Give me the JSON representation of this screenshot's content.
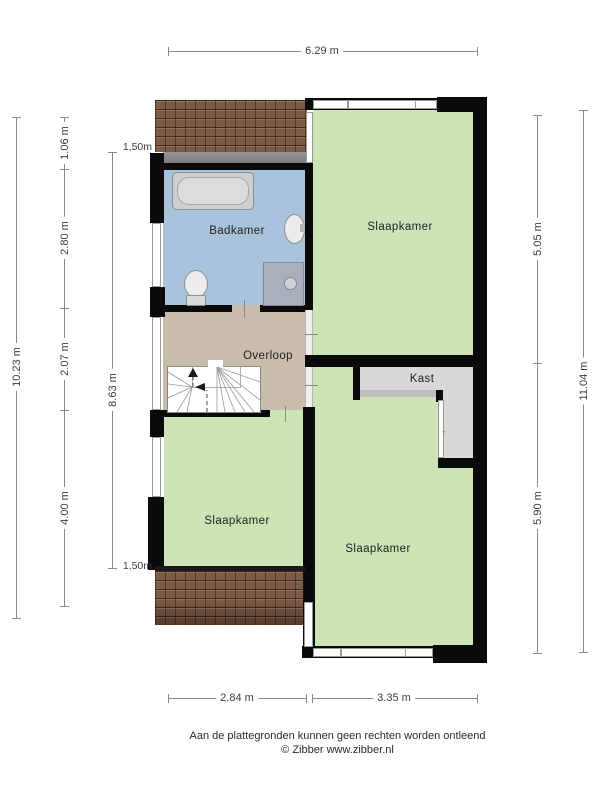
{
  "floorplan": {
    "rooms": {
      "badkamer": {
        "label": "Badkamer",
        "color": "#a9c3dd"
      },
      "slaapkamer_top": {
        "label": "Slaapkamer",
        "color": "#cde4b6"
      },
      "overloop": {
        "label": "Overloop",
        "color": "#c9bcaa"
      },
      "kast": {
        "label": "Kast",
        "color": "#d8d8d8"
      },
      "slaapkamer_left": {
        "label": "Slaapkamer",
        "color": "#cde4b6"
      },
      "slaapkamer_bottom": {
        "label": "Slaapkamer",
        "color": "#cde4b6"
      }
    },
    "colors": {
      "wall": "#0a0a0a",
      "roof": "#7d5b46",
      "dormer": "#8e8e8e",
      "window_frame": "#9a9a9a",
      "dimension_line": "#8a8a8a",
      "dimension_text": "#3c3c3c"
    }
  },
  "dimensions": {
    "top": "6.29 m",
    "left_outer": "10.23 m",
    "left_segments": [
      "1.06 m",
      "2.80 m",
      "2.07 m",
      "4.00 m"
    ],
    "left_inner": "8.63 m",
    "knee_wall_top": "1,50m",
    "knee_wall_bottom": "1,50m",
    "right_upper": "5.05 m",
    "right_lower": "5.90 m",
    "right_outer": "11.04 m",
    "bottom_left": "2.84 m",
    "bottom_right": "3.35 m"
  },
  "footer": {
    "disclaimer": "Aan de plattegronden kunnen geen rechten worden ontleend",
    "copyright": "© Zibber www.zibber.nl"
  }
}
